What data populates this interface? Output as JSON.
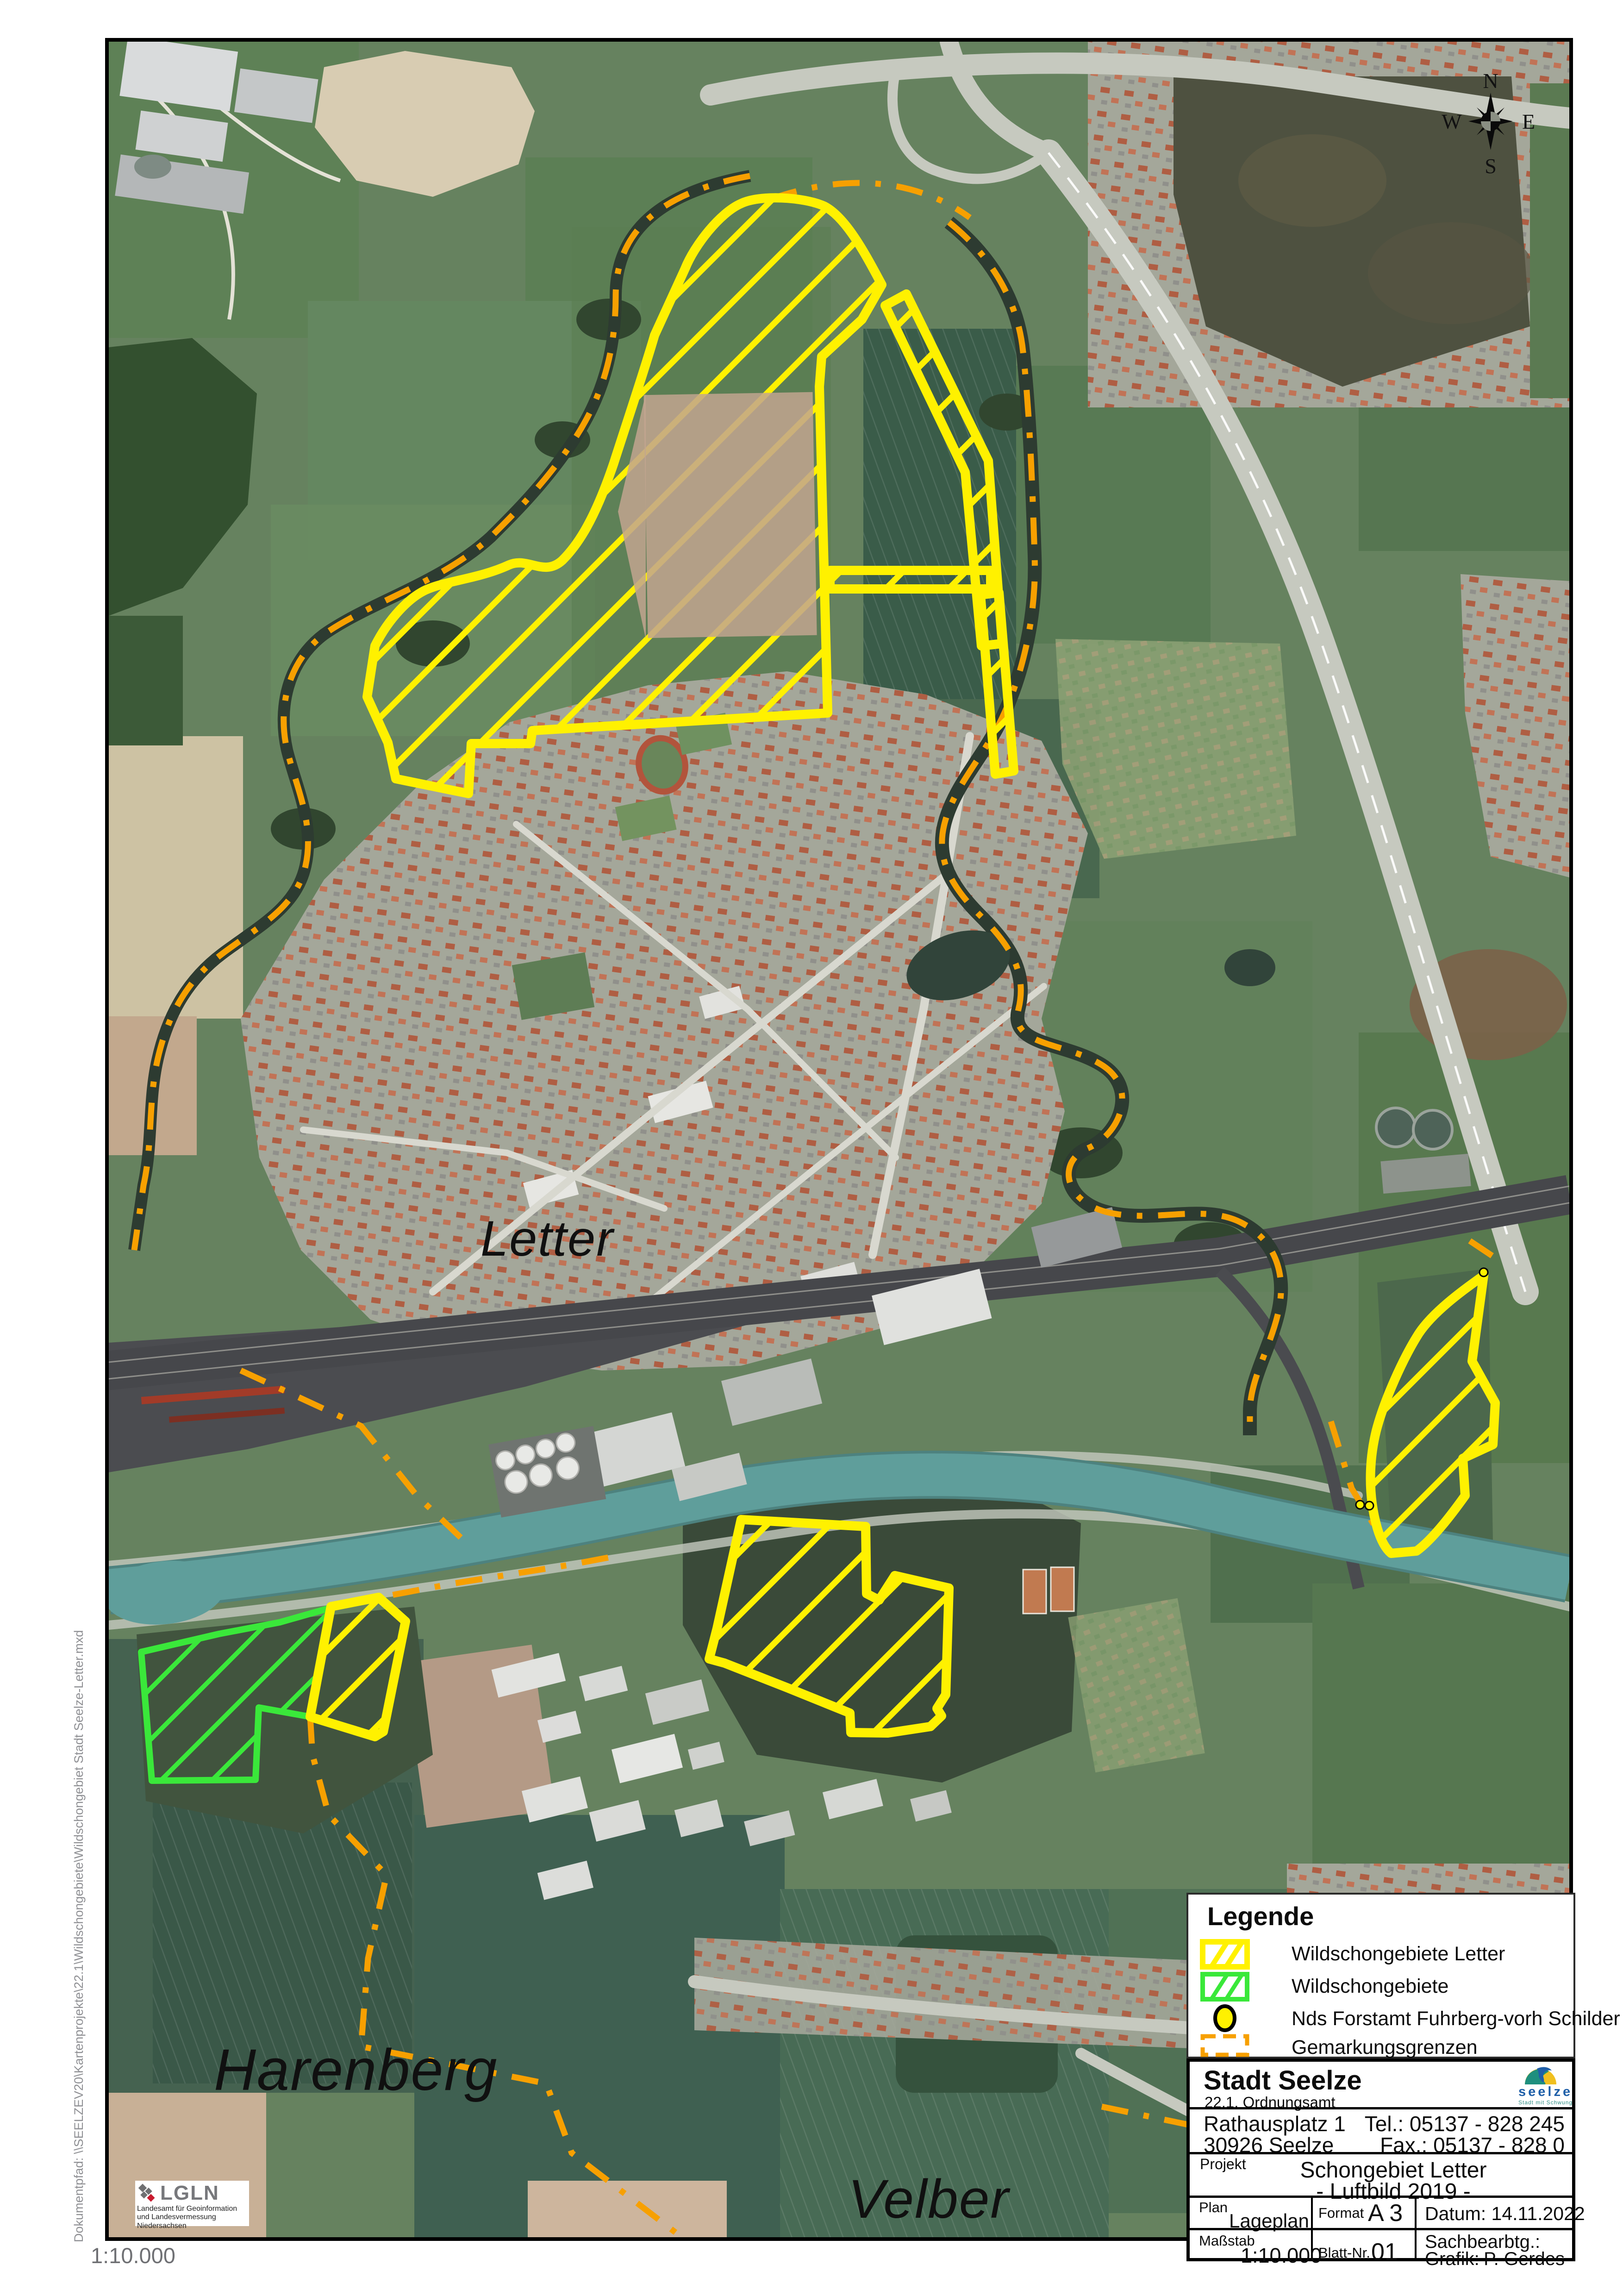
{
  "margins": {
    "doc_path": "Dokumentpfad: \\\\SEELZEV20\\Kartenprojekte\\22.1\\Wildschongebiete\\Wildschongebiet Stadt Seelze-Letter.mxd",
    "scale_note": "1:10.000"
  },
  "map": {
    "labels": {
      "town": "Letter",
      "village_sw": "Harenberg",
      "village_se": "Velber"
    },
    "compass": {
      "n": "N",
      "e": "E",
      "s": "S",
      "w": "W"
    },
    "lgln": {
      "abbr": "LGLN",
      "line1": "Landesamt für Geoinformation",
      "line2": "und Landesvermessung Niedersachsen"
    },
    "colors": {
      "wildschongebiete_letter": "#fff100",
      "wildschongebiete": "#3ae83a",
      "gemarkungsgrenzen": "#f7a000",
      "forstamt_marker": "#fff100",
      "canal": "#5f9e9b"
    }
  },
  "legend": {
    "title": "Legende",
    "items": [
      {
        "label": "Wildschongebiete Letter"
      },
      {
        "label": "Wildschongebiete"
      },
      {
        "label": "Nds Forstamt Fuhrberg-vorh Schilder"
      },
      {
        "label": "Gemarkungsgrenzen"
      }
    ]
  },
  "title_block": {
    "org": "Stadt Seelze",
    "dept": "22.1. Ordnungsamt",
    "logo_name": "seelze",
    "logo_tagline": "Stadt mit Schwung",
    "address_line1": "Rathausplatz 1",
    "address_line2": "30926 Seelze",
    "tel": "Tel.: 05137 - 828 245",
    "fax": "Fax.: 05137 - 828 0",
    "projekt_label": "Projekt",
    "projekt_line1": "Schongebiet Letter",
    "projekt_line2": "- Luftbild 2019 -",
    "plan_label": "Plan",
    "plan_value": "Lageplan",
    "format_label": "Format",
    "format_value": "A 3",
    "datum": "Datum: 14.11.2022",
    "massstab_label": "Maßstab",
    "massstab_value": "1:10.000",
    "blatt_label": "Blatt-Nr.",
    "blatt_value": "01",
    "sachbearbtg_label": "Sachbearbtg.:",
    "grafik_label": "Grafik:",
    "grafik_value": "P. Gerdes"
  }
}
